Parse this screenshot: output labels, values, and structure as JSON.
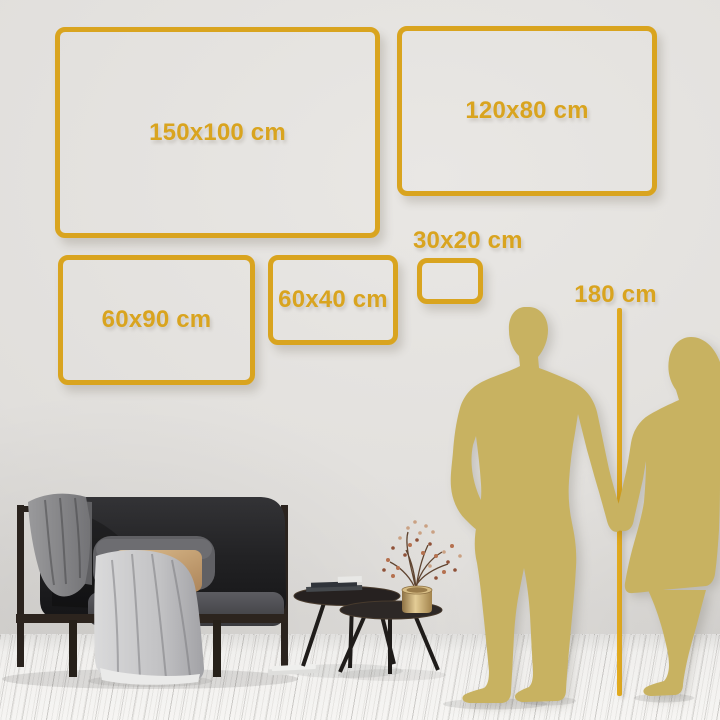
{
  "colors": {
    "accent_gold": "#D9A41F",
    "silhouette_gold": "#C8B261",
    "wall": "#E0DEDB",
    "floor": "#F1F0EE"
  },
  "size_options": [
    {
      "label": "150x100 cm"
    },
    {
      "label": "120x80 cm"
    },
    {
      "label": "60x90 cm"
    },
    {
      "label": "60x40 cm"
    },
    {
      "label": "30x20 cm"
    }
  ],
  "height_marker": {
    "label": "180 cm"
  },
  "scene": {
    "couple": "man-and-woman-holding-hands-silhouette",
    "height_line": "vertical-measure-line",
    "furniture": [
      "dark-sofa-with-gray-blankets-and-pillows",
      "two-round-nesting-coffee-tables",
      "stack-of-books",
      "brass-vase-with-dried-flower-branches",
      "magazine-on-floor"
    ],
    "floor": "white-wood-plank-floor",
    "wall": "light-gray-wall"
  }
}
